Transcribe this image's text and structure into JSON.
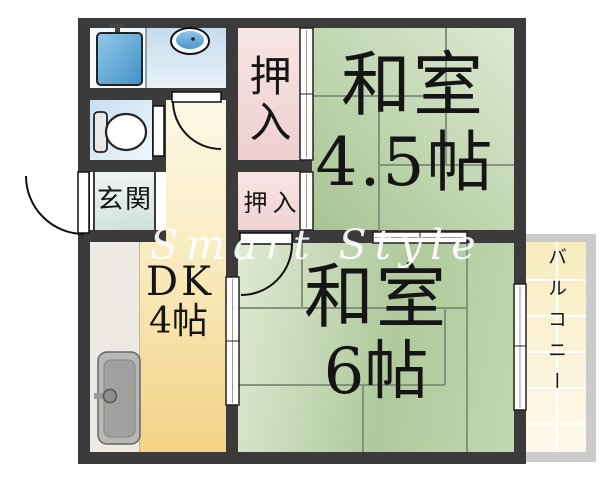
{
  "watermark": "Smart Style",
  "rooms": {
    "washitsu_45": {
      "name": "和室",
      "size": "4.5帖"
    },
    "washitsu_6": {
      "name": "和室",
      "size": "6帖"
    },
    "dk": {
      "name": "DK",
      "size": "4帖"
    },
    "genkan": {
      "label": "玄関"
    },
    "closet_upper": {
      "label": "押入"
    },
    "closet_lower": {
      "label": "押入"
    },
    "balcony": {
      "label": "バルコニー"
    }
  },
  "fixtures": {
    "bathtub": "bathtub-icon",
    "wash_basin": "wash-basin-icon",
    "toilet": "toilet-icon",
    "kitchen_sink": "kitchen-sink-icon"
  },
  "colors": {
    "wall": "#3b3b3b",
    "tatami_green_light": "#dde9d2",
    "tatami_green_dark": "#a7c492",
    "closet_pink": "#f0d2d2",
    "dk_yellow": "#f4d285",
    "hall_cream": "#fcf8e6",
    "water_blue": "#4a97cc",
    "genkan_teal": "#cfe0da",
    "balcony_cream": "#f7ecbe",
    "counter_gray": "#eceae2"
  }
}
